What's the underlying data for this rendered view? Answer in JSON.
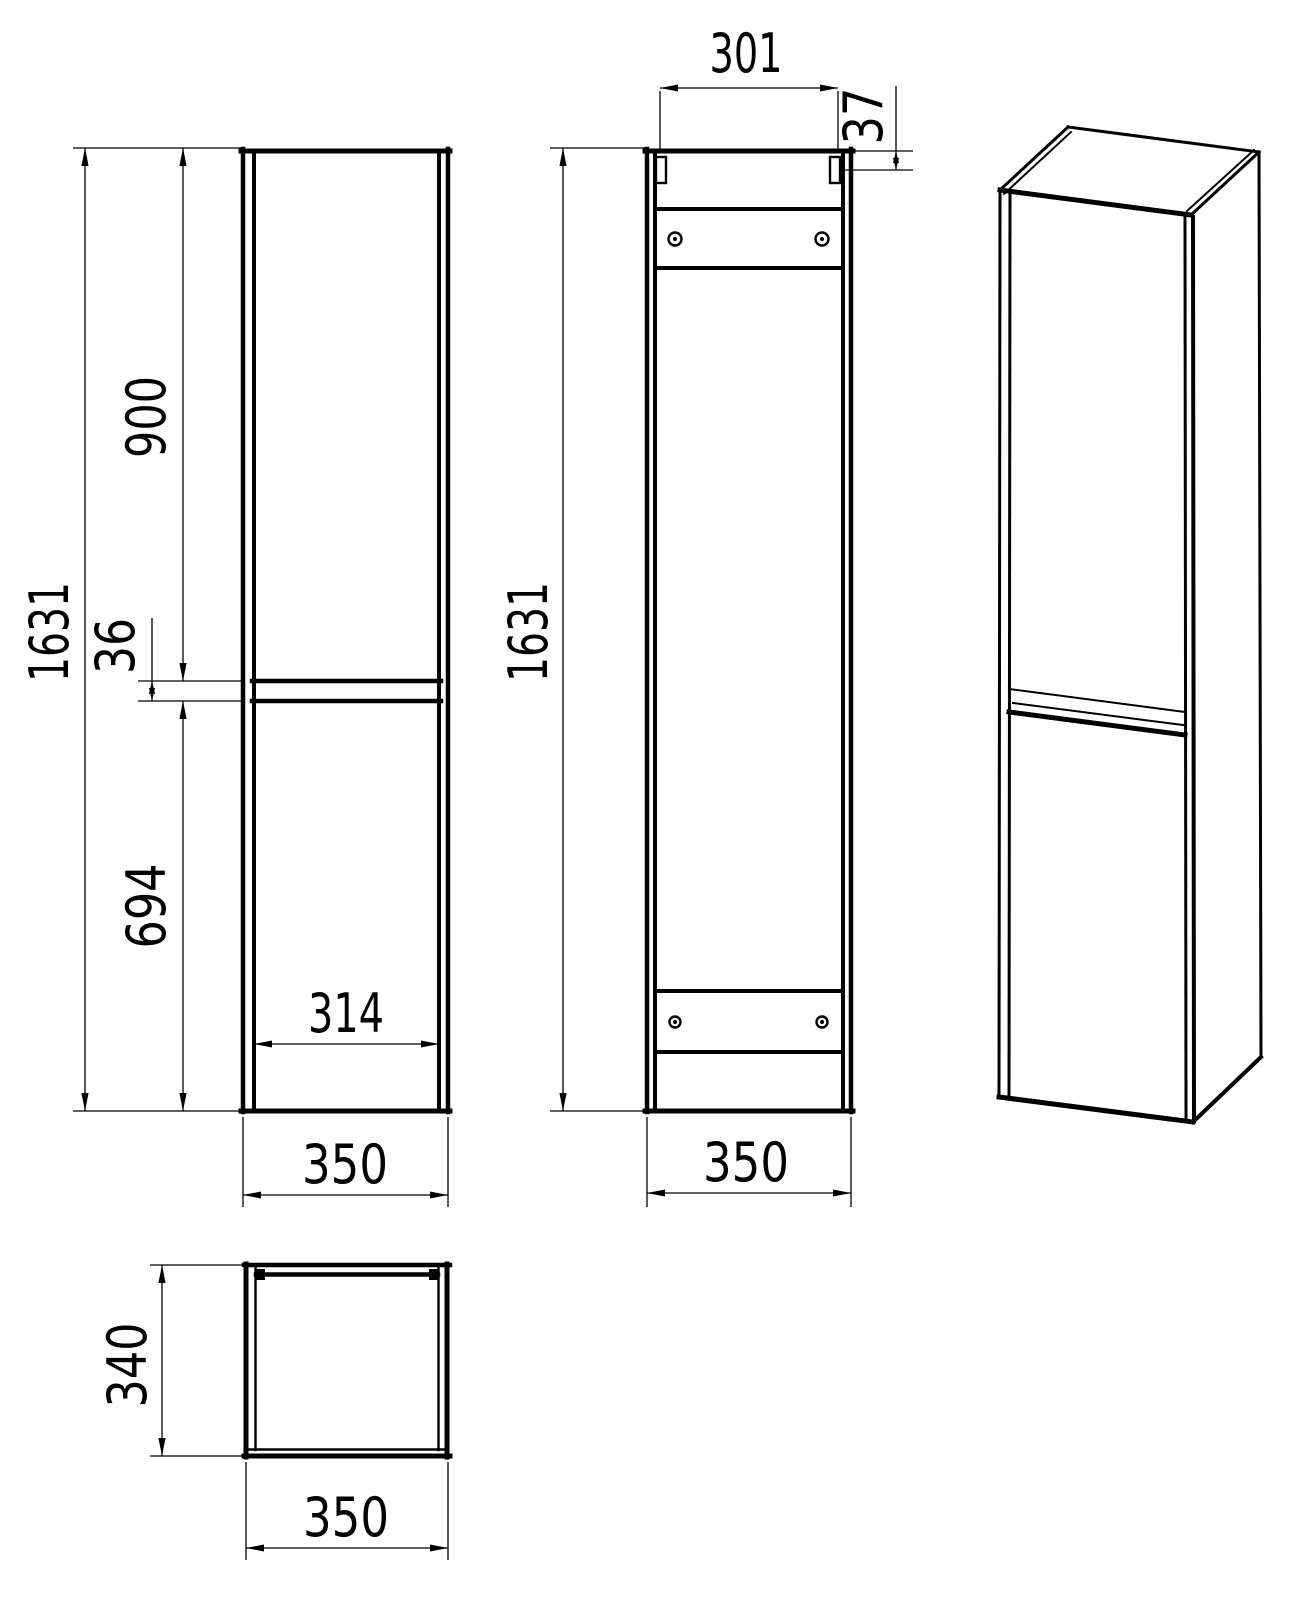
{
  "drawing": {
    "colors": {
      "line": "#000000",
      "background": "#ffffff"
    },
    "views": {
      "front": {
        "dims": {
          "height_total": "1631",
          "door_top_height": "900",
          "door_gap": "36",
          "door_bottom_height": "694",
          "door_width": "314",
          "width": "350"
        }
      },
      "back": {
        "dims": {
          "bracket_span": "301",
          "bracket_offset": "37",
          "height_total": "1631",
          "width": "350"
        }
      },
      "top": {
        "dims": {
          "depth": "340",
          "width": "350"
        }
      }
    }
  }
}
